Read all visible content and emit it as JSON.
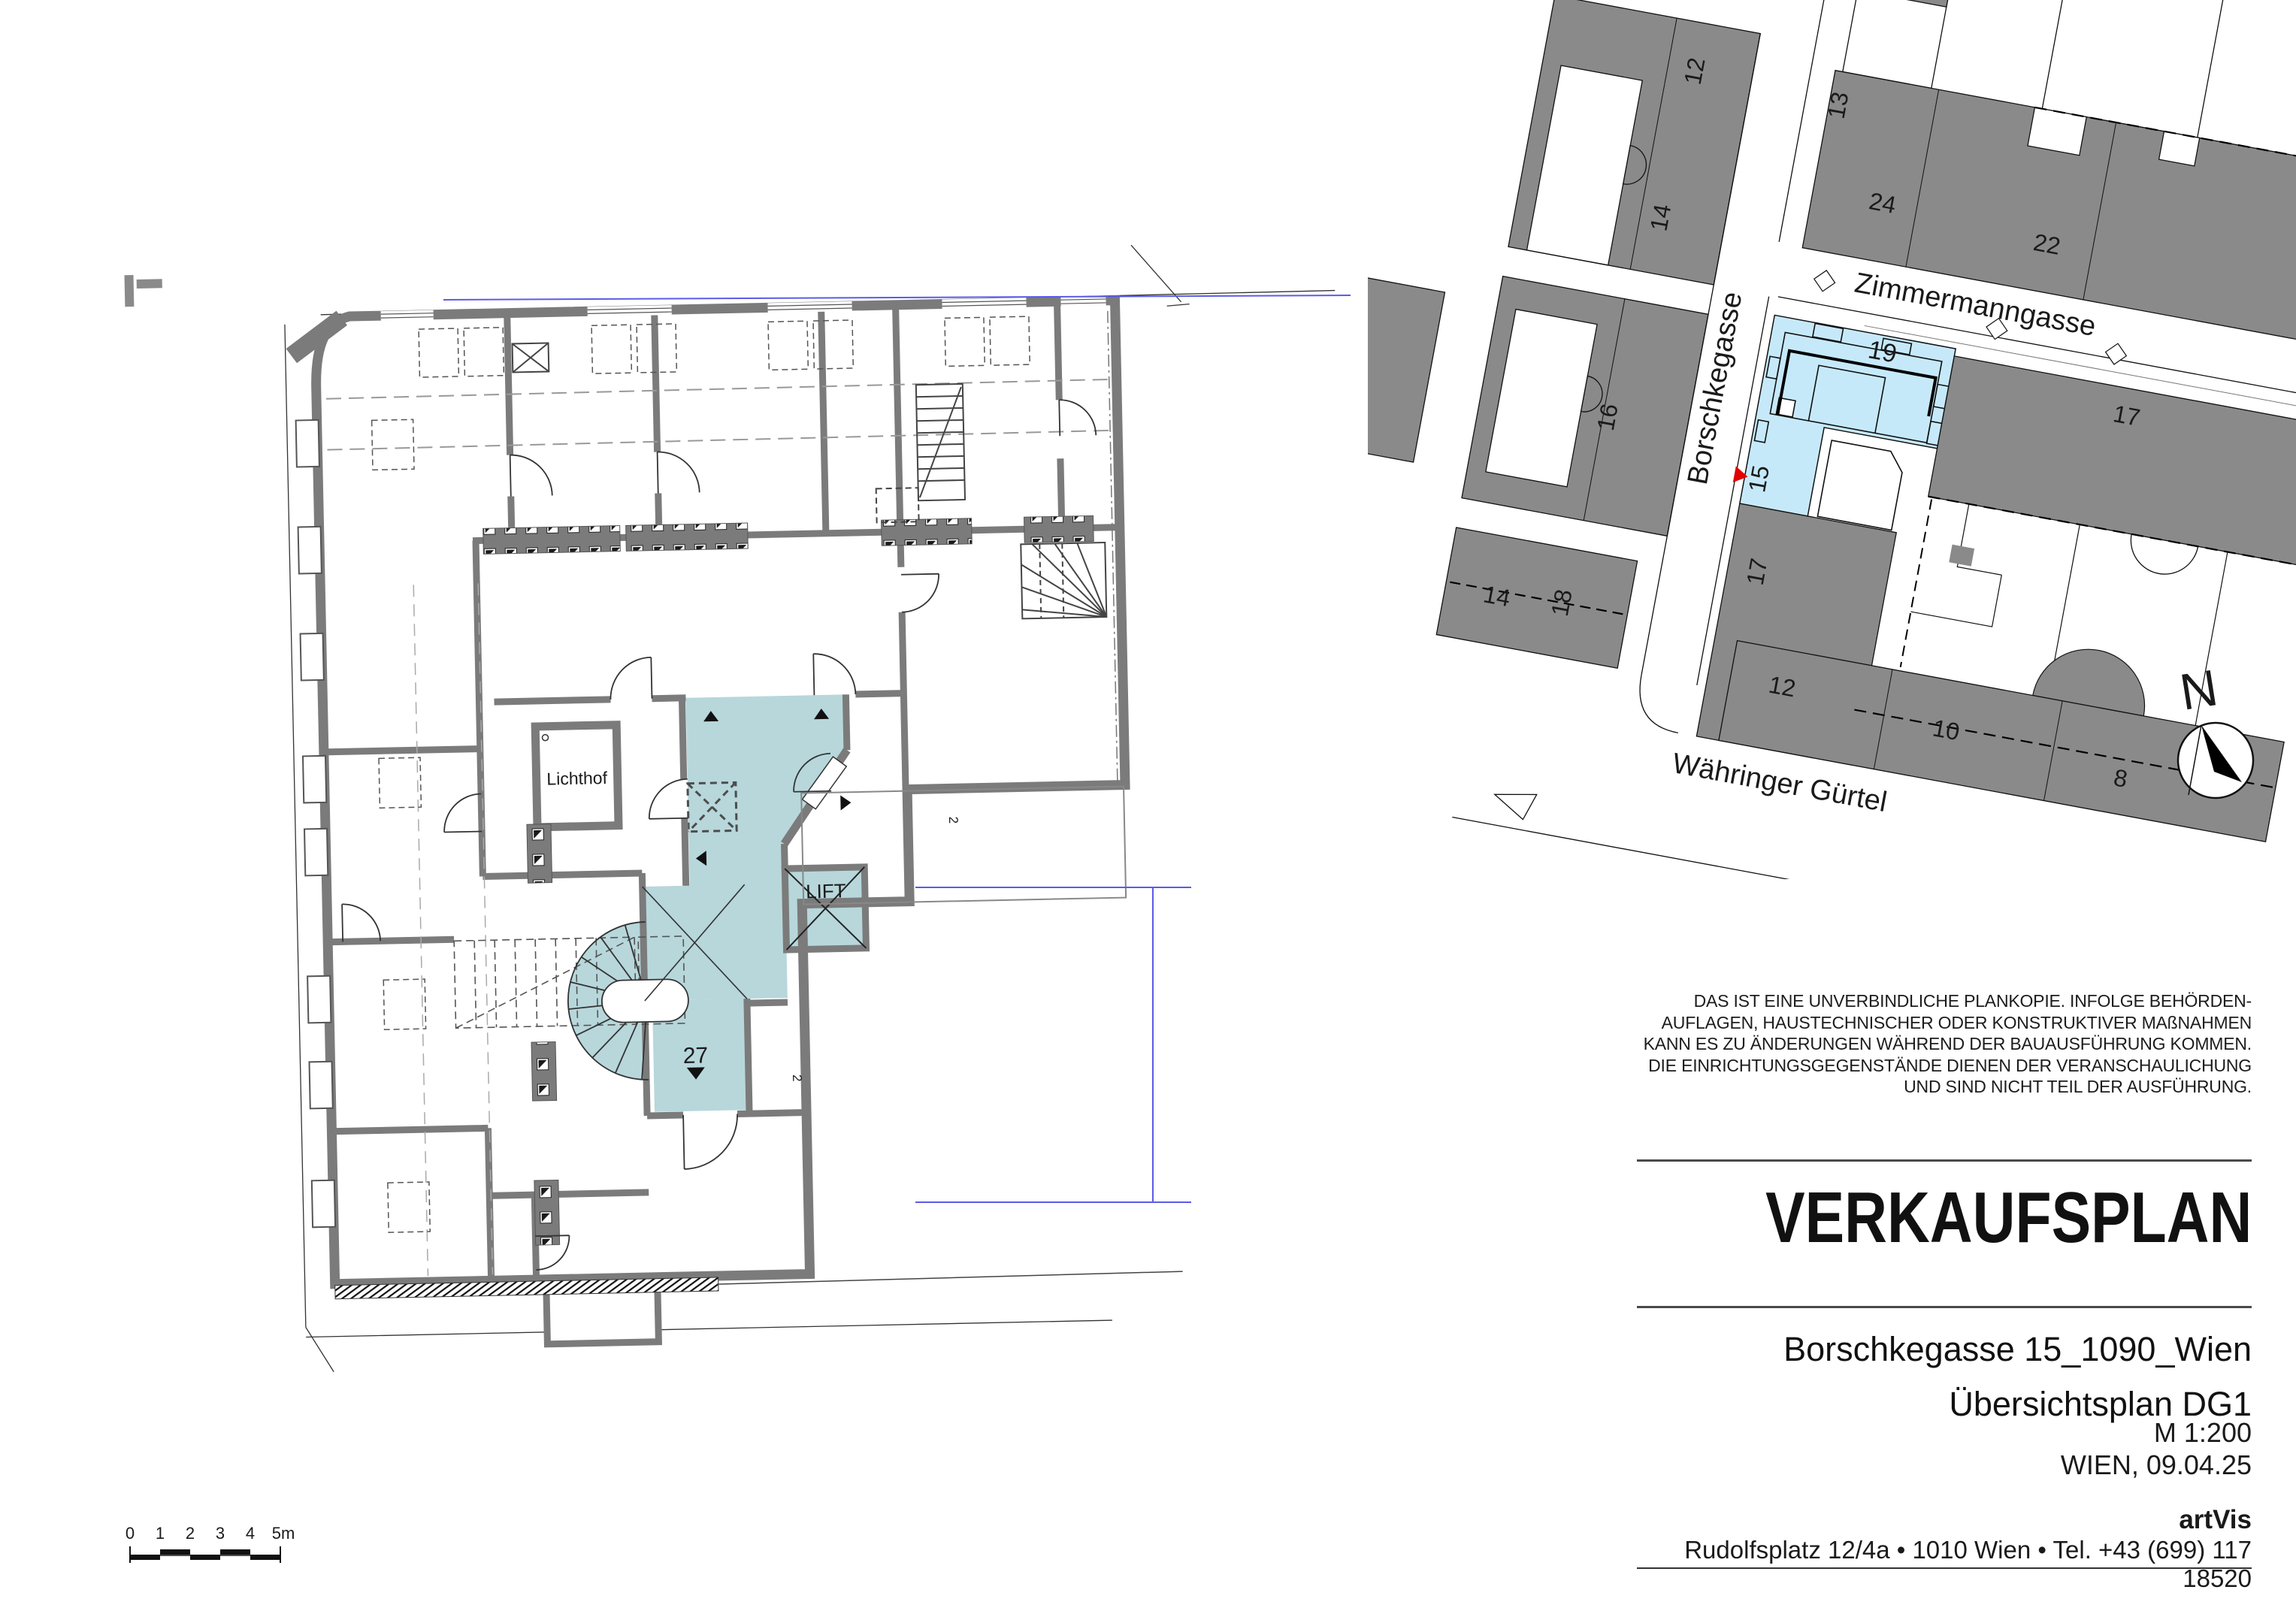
{
  "floor_plan": {
    "room_labels": {
      "lichthof": "Lichthof",
      "lift": "LIFT",
      "apartment_number": "27"
    },
    "door_width_label": "2",
    "highlight_color": "#b7d7db",
    "wall_color": "#7b7b7b"
  },
  "scale_bar": {
    "labels": [
      "0",
      "1",
      "2",
      "3",
      "4",
      "5m"
    ]
  },
  "site_map": {
    "street_names": {
      "borschkegasse": "Borschkegasse",
      "zimmermanngasse": "Zimmermanngasse",
      "waehringer_guertel": "Währinger Gürtel"
    },
    "north_label": "N",
    "highlight_color": "#c6e9fa",
    "building_color": "#8a8a8a",
    "parcel_number_color": "#9a9a9a",
    "marker_color": "#e00000",
    "house_numbers": {
      "west_12": "12",
      "west_14": "14",
      "west_16": "16",
      "west_14b": "14",
      "west_18": "18",
      "north_13": "13",
      "north_24": "24",
      "north_22": "22",
      "parcel_19": "19",
      "east_17": "17",
      "south_17": "17",
      "street_15": "15",
      "guertel_12": "12",
      "guertel_10": "10",
      "guertel_8": "8"
    }
  },
  "title_block": {
    "disclaimer_lines": [
      "DAS IST EINE UNVERBINDLICHE PLANKOPIE. INFOLGE BEHÖRDEN-",
      "AUFLAGEN, HAUSTECHNISCHER ODER KONSTRUKTIVER MAßNAHMEN",
      "KANN ES ZU ÄNDERUNGEN WÄHREND DER BAUAUSFÜHRUNG KOMMEN.",
      "DIE EINRICHTUNGSGEGENSTÄNDE DIENEN DER VERANSCHAULICHUNG",
      "UND SIND NICHT TEIL DER AUSFÜHRUNG."
    ],
    "title": "VERKAUFSPLAN",
    "address": "Borschkegasse 15_1090_Wien",
    "plan_name": "Übersichtsplan DG1",
    "scale": "M 1:200",
    "city_date": "WIEN, 09.04.25",
    "company": "artVis",
    "company_address": "Rudolfsplatz 12/4a • 1010 Wien • Tel. +43 (699) 117 18520"
  }
}
